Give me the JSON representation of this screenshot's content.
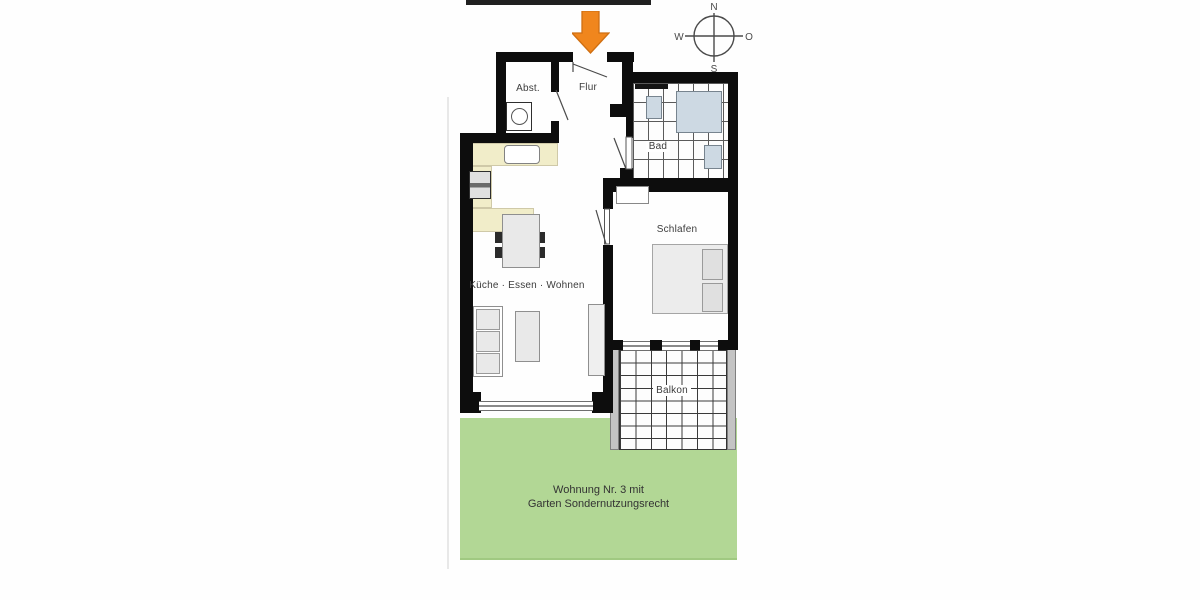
{
  "plan": {
    "type": "floor-plan",
    "rooms": {
      "abst": {
        "label": "Abst."
      },
      "flur": {
        "label": "Flur"
      },
      "bad": {
        "label": "Bad"
      },
      "schlafen": {
        "label": "Schlafen"
      },
      "wohnen": {
        "label": "Küche · Essen · Wohnen"
      },
      "balkon": {
        "label": "Balkon"
      }
    },
    "garden": {
      "label_line1": "Wohnung Nr. 3 mit",
      "label_line2": "Garten Sondernutzungsrecht"
    },
    "compass": {
      "north": "N",
      "east": "O",
      "south": "S",
      "west": "W"
    },
    "colors": {
      "wall": "#0d0d0d",
      "kitchen_counter": "#f1edc9",
      "furniture_fill": "#e9e9e9",
      "bath_fixture": "#cdd9e3",
      "garden_green": "#b2d795",
      "entrance_arrow": "#f0861d",
      "label_text": "#3c3c3c"
    }
  }
}
